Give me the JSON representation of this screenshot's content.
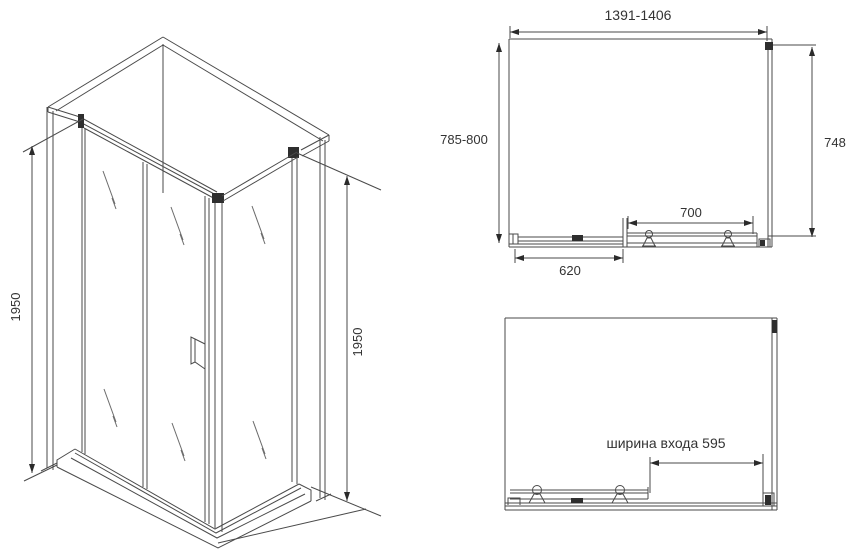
{
  "drawing_title": "corner-shower-enclosure-technical-drawing",
  "colors": {
    "background": "#ffffff",
    "line": "#4a4a4a",
    "dark_detail": "#2e2e2e",
    "text": "#333333"
  },
  "iso_view": {
    "height_left": "1950",
    "height_right": "1950"
  },
  "plan_view": {
    "width_range": "1391-1406",
    "depth_range": "785-800",
    "side_depth": "748",
    "door_track_width": "700",
    "fixed_panel_width": "620"
  },
  "open_view": {
    "entrance_width_label": "ширина входа 595"
  }
}
